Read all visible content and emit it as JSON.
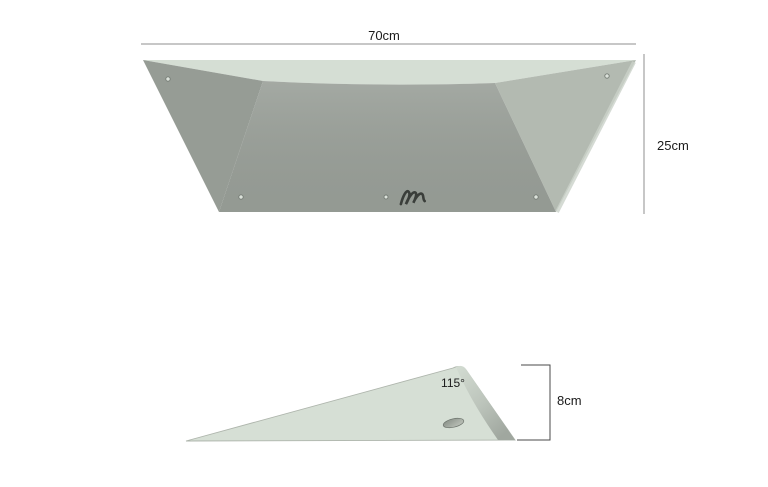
{
  "top_view": {
    "width_dimension": "70cm",
    "height_dimension": "25cm"
  },
  "side_view": {
    "angle_dimension": "115°",
    "height_dimension": "8cm"
  },
  "icons": {
    "logo": "script-n-brand-mark"
  },
  "colors": {
    "background": "#ffffff",
    "top_surface": "#d5ded4",
    "left_face": "#969c95",
    "front_face": "#9aa099",
    "right_face": "#b3bab1",
    "edge_highlight": "#cbd2c9",
    "hole_fill": "#dce2db",
    "hole_ring": "#747b74",
    "logo": "#3a3e3a",
    "wedge_face": "#d6dfd5",
    "wedge_outline": "#aeb5ac",
    "wedge_hole_ring": "#6d746d",
    "dimension_line": "#8f8f8f",
    "bracket_line": "#4a4a4a",
    "label_text": "#1b1b1b"
  }
}
